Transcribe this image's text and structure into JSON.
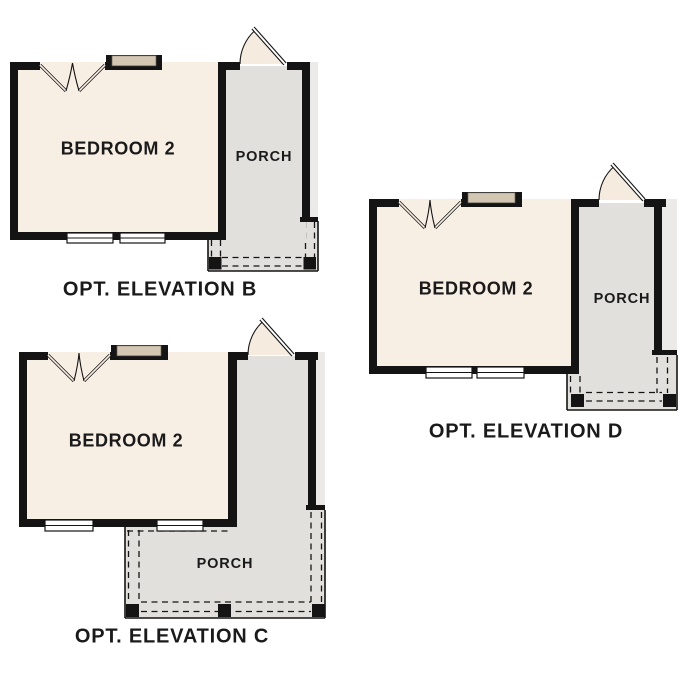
{
  "colors": {
    "wall": "#141414",
    "bedroom_fill": "#f7eee4",
    "porch_fill": "#e2e0dd",
    "eave_fill": "#eceae8",
    "window_header_fill": "#d3c6b2",
    "door_leaf_fill": "#f5ecdf",
    "outline": "#141414",
    "label_text": "#1a1a1a",
    "background": "#ffffff"
  },
  "plans": [
    {
      "id": "B",
      "room_label": "BEDROOM 2",
      "porch_label": "PORCH",
      "title": "OPT. ELEVATION B"
    },
    {
      "id": "C",
      "room_label": "BEDROOM 2",
      "porch_label": "PORCH",
      "title": "OPT. ELEVATION C"
    },
    {
      "id": "D",
      "room_label": "BEDROOM 2",
      "porch_label": "PORCH",
      "title": "OPT. ELEVATION D"
    }
  ]
}
